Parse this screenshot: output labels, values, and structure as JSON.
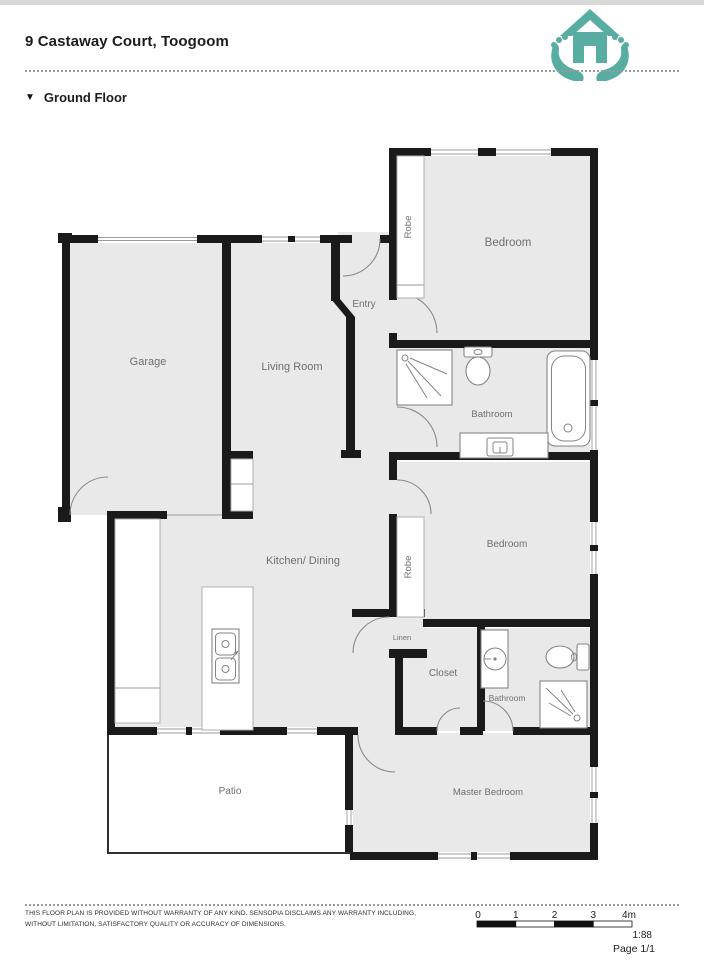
{
  "header": {
    "title": "9 Castaway Court, Toogoom"
  },
  "logo": {
    "icon": "house-in-hands-icon",
    "color": "#57ada1"
  },
  "section": {
    "marker": "▼",
    "label": "Ground Floor"
  },
  "floor_plan": {
    "colors": {
      "wall": "#1a1a1a",
      "floor": "#e9e9e9"
    },
    "rooms": {
      "garage": "Garage",
      "living_room": "Living Room",
      "entry": "Entry",
      "bedroom_top": "Bedroom",
      "robe_top": "Robe",
      "bathroom_top": "Bathroom",
      "kitchen_dining": "Kitchen/ Dining",
      "robe_middle": "Robe",
      "bedroom_middle": "Bedroom",
      "linen": "Linen",
      "closet": "Closet",
      "bathroom_bottom": "Bathroom",
      "patio": "Patio",
      "master_bedroom": "Master Bedroom"
    }
  },
  "footer": {
    "disclaimer_line1": "THIS FLOOR PLAN IS PROVIDED WITHOUT WARRANTY OF ANY KIND. SENSOPIA DISCLAIMS ANY WARRANTY INCLUDING,",
    "disclaimer_line2": "WITHOUT LIMITATION, SATISFACTORY QUALITY OR ACCURACY OF DIMENSIONS.",
    "scale": {
      "ticks": [
        "0",
        "1",
        "2",
        "3",
        "4m"
      ],
      "ratio": "1:88"
    },
    "page": "Page 1/1"
  }
}
